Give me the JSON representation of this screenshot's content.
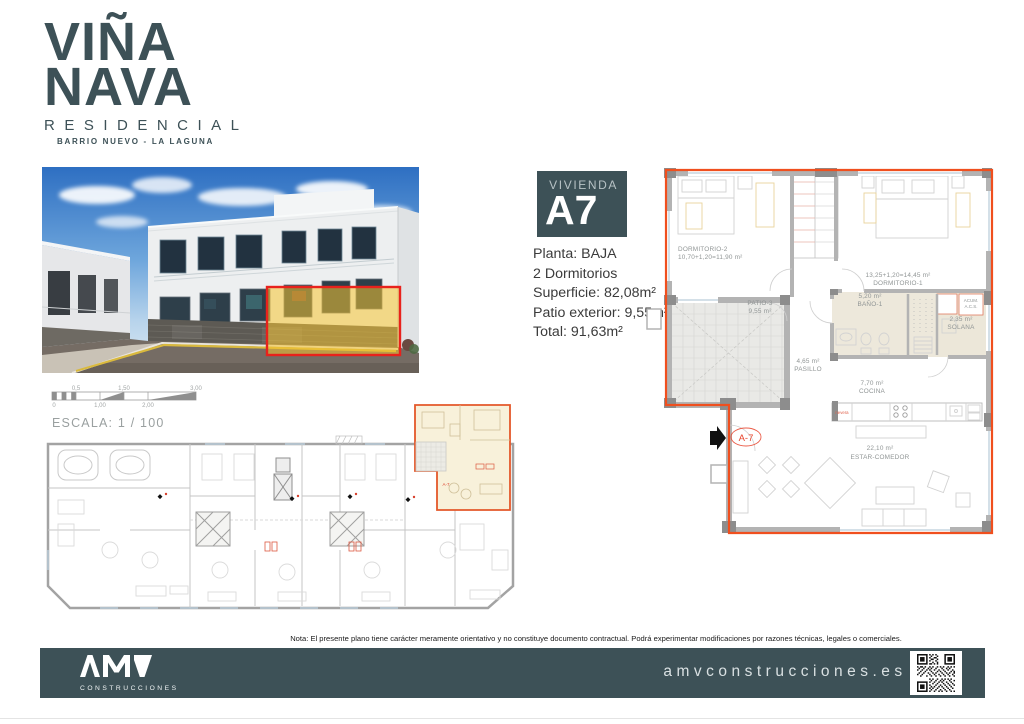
{
  "brand": {
    "color": "#3d5157",
    "line1": "VIÑA",
    "line2": "NAVA",
    "subtitle": "RESIDENCIAL",
    "location": "BARRIO NUEVO - LA LAGUNA"
  },
  "photo": {
    "highlight_border": "#e8221c",
    "highlight_fill": "#f5c532"
  },
  "scale": {
    "label": "ESCALA: 1 / 100",
    "ticks_top": [
      "0,5",
      "1,50",
      "3,00"
    ],
    "ticks_bottom": [
      "0",
      "1,00",
      "2,00"
    ]
  },
  "unit_card": {
    "label": "VIVIENDA",
    "code": "A7",
    "details": [
      "Planta: BAJA",
      "2 Dormitorios",
      "Superficie: 82,08m²",
      "Patio exterior: 9,55m²",
      "Total: 91,63m²"
    ]
  },
  "floorplan": {
    "outline_color": "#f04f1e",
    "unit_label": "A-7",
    "acs_line1": "ACUM.",
    "acs_line2": "A.C.S.",
    "nevera": "nevera",
    "rooms": [
      {
        "name": "DORMITORIO-2",
        "area": "10,70+1,20=11,90 m²"
      },
      {
        "name": "DORMITORIO-1",
        "area": "13,25+1,20=14,45 m²"
      },
      {
        "name": "PATIO-3",
        "area": "9,55 m²"
      },
      {
        "name": "BAÑO-1",
        "area": "5,20 m²"
      },
      {
        "name": "SOLANA",
        "area": "2,35 m²"
      },
      {
        "name": "PASILLO",
        "area": "4,65 m²"
      },
      {
        "name": "COCINA",
        "area": "7,70 m²"
      },
      {
        "name": "ESTAR-COMEDOR",
        "area": "22,10 m²"
      }
    ]
  },
  "note": {
    "text": "Nota: El presente plano tiene carácter meramente orientativo y no constituye documento contractual. Podrá experimentar modificaciones por razones técnicas, legales o comerciales."
  },
  "footer": {
    "bg": "#3d5157",
    "logo_text": "AMV",
    "logo_subtext": "CONSTRUCCIONES",
    "website": "amvconstrucciones.es"
  }
}
